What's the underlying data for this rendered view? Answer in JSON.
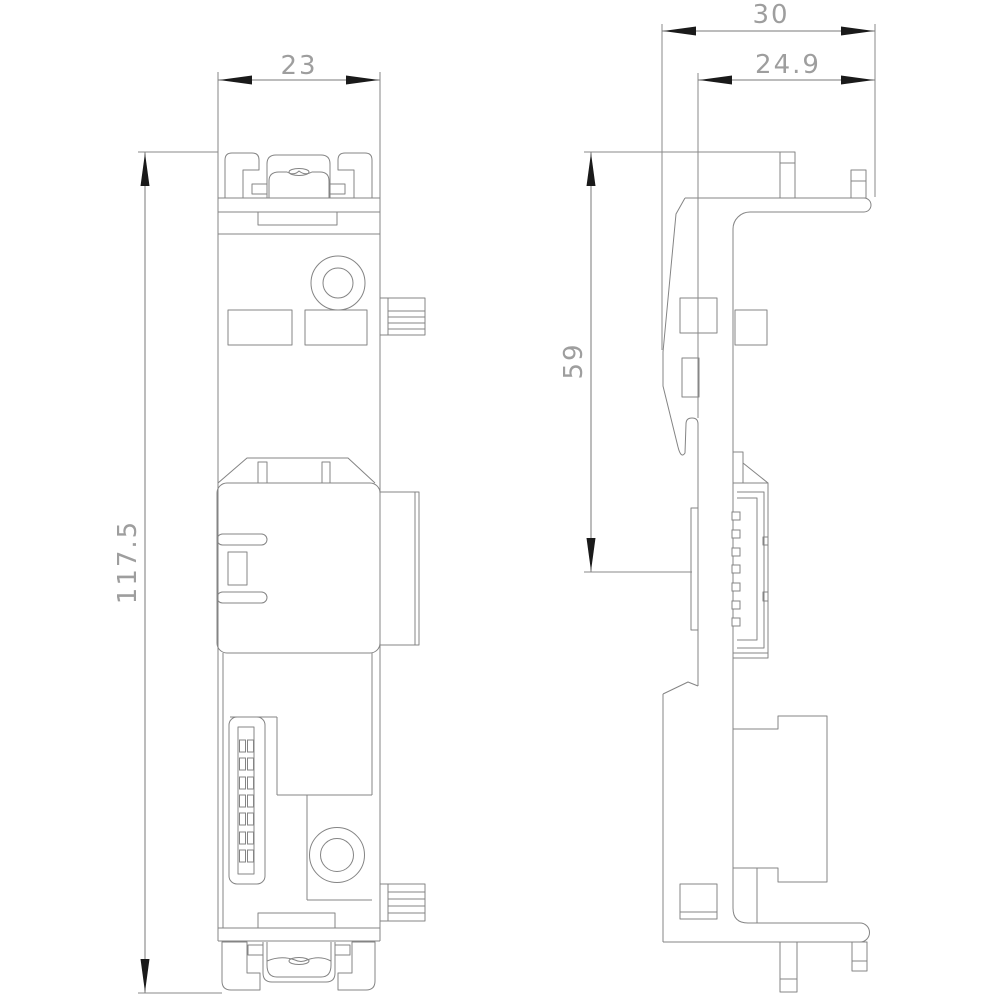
{
  "drawing": {
    "type": "technical-dimension-drawing",
    "dimension_labels": {
      "front_width": "23",
      "front_height": "117.5",
      "side_depth_total": "30",
      "side_depth_front": "24.9",
      "side_mount_height": "59"
    },
    "colors": {
      "background": "#ffffff",
      "line": "#848484",
      "arrow": "#1a1a1a",
      "dimension_text": "#9e9e9e"
    }
  }
}
